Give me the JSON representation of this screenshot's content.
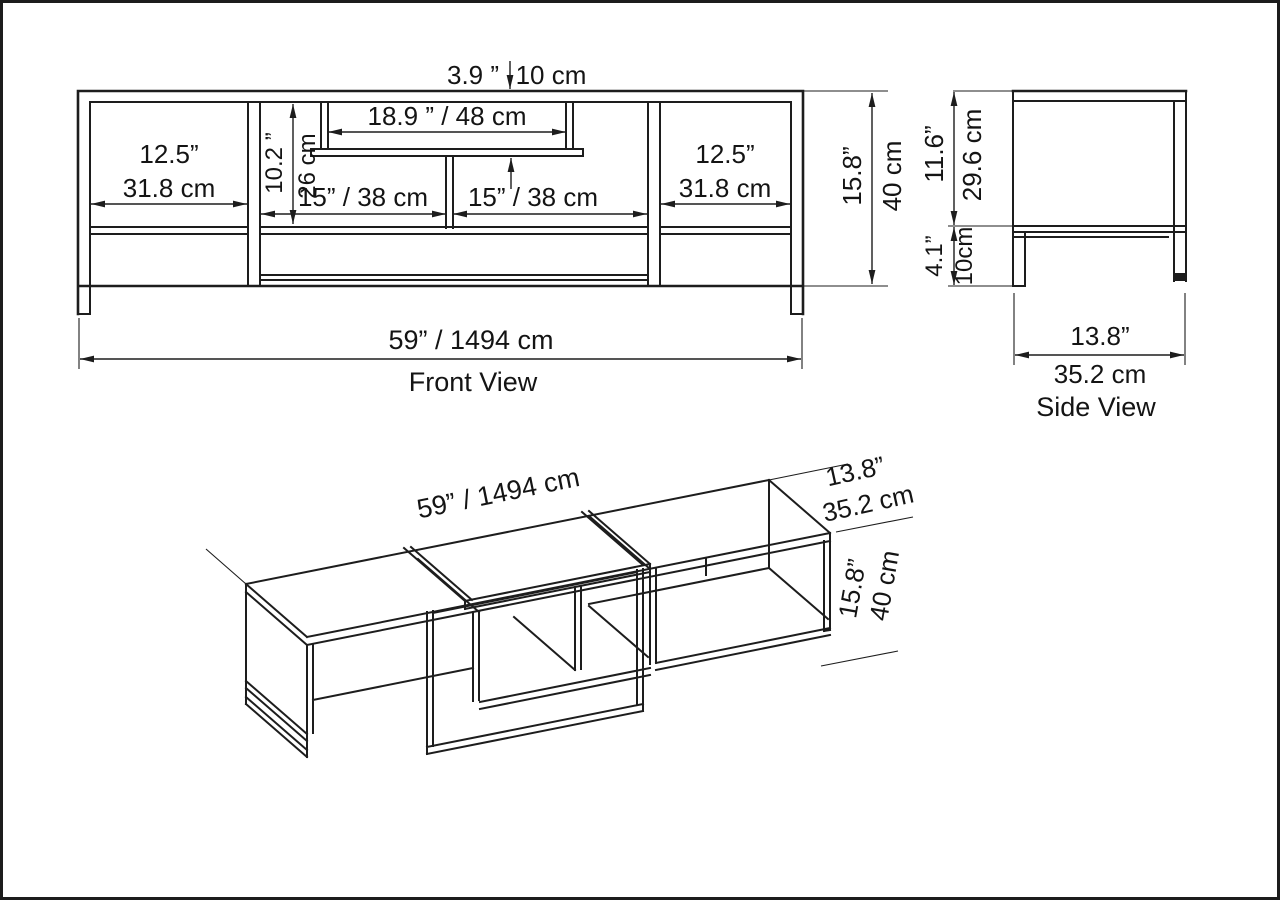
{
  "page": {
    "background": "#ffffff",
    "line_color": "#1d1d1d",
    "border_color": "#1c1c1c"
  },
  "front_view": {
    "title": "Front View",
    "overall_width": "59” / 1494 cm",
    "overall_height_in": "15.8”",
    "overall_height_cm": "40 cm",
    "top_shelf_gap_in": "3.9 ”",
    "top_shelf_gap_cm": "10 cm",
    "tv_shelf_width": "18.9 ” / 48 cm",
    "inner_height_in": "10.2 ”",
    "inner_height_cm": "26 cm",
    "left_compartment_in": "12.5”",
    "left_compartment_cm": "31.8 cm",
    "mid_compartment_left": "15” / 38 cm",
    "mid_compartment_right": "15” / 38 cm",
    "right_compartment_in": "12.5”",
    "right_compartment_cm": "31.8 cm"
  },
  "side_view": {
    "title": "Side View",
    "depth_in": "13.8”",
    "depth_cm": "35.2 cm",
    "upper_height_in": "11.6”",
    "upper_height_cm": "29.6 cm",
    "leg_height_in": "4.1”",
    "leg_height_cm": "10cm"
  },
  "isometric_view": {
    "length": "59” / 1494 cm",
    "depth_in": "13.8”",
    "depth_cm": "35.2 cm",
    "height_in": "15.8”",
    "height_cm": "40 cm"
  }
}
